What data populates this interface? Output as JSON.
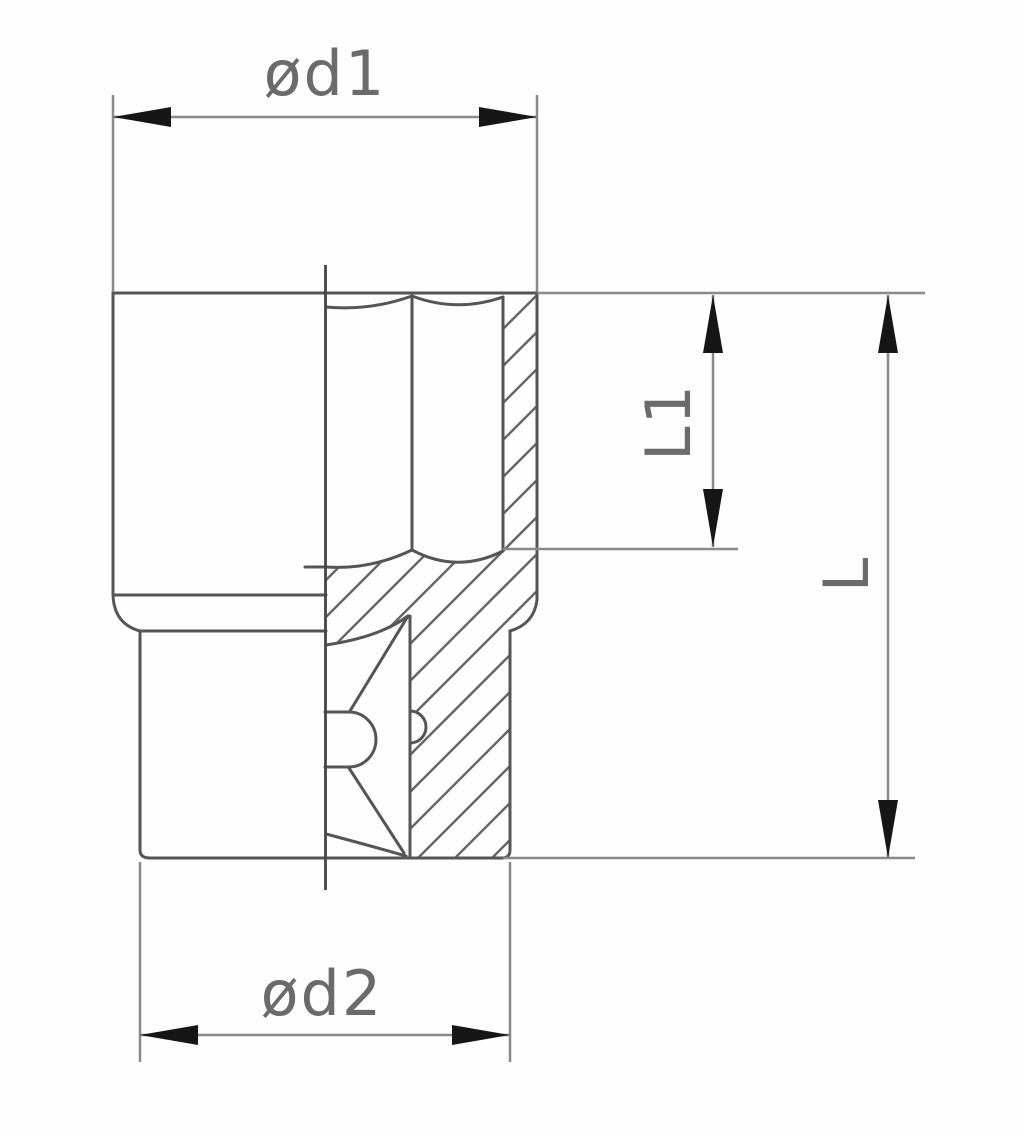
{
  "drawing": {
    "type": "technical-section-drawing",
    "subject": "socket wrench cross-section with dimension annotations",
    "dimension_labels": {
      "top_diameter": "ød1",
      "bottom_diameter": "ød2",
      "bore_depth": "L1",
      "total_length": "L"
    }
  },
  "colors": {
    "background": "#fdfdfd",
    "outline": "#555555",
    "dimension": "#8a8a8a",
    "centerline": "#454545",
    "hatch": "#666666",
    "arrow": "#161616",
    "label_text": "#6b6b6b"
  }
}
